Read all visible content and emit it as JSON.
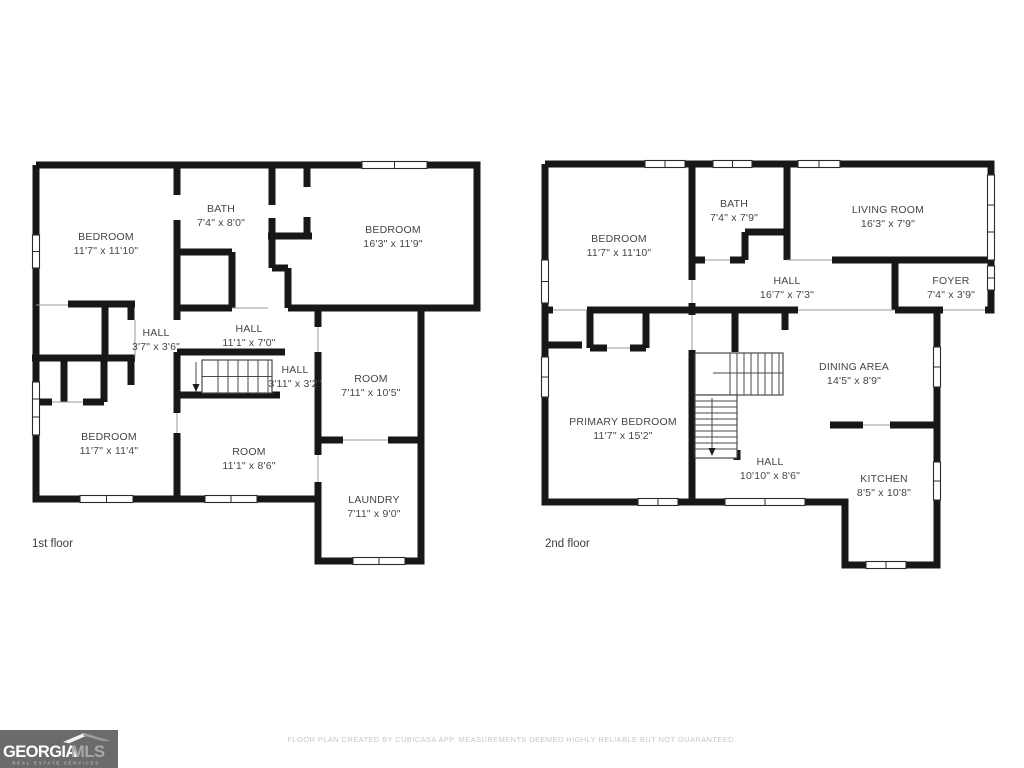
{
  "colors": {
    "wall": "#171717",
    "label_text": "#454545",
    "floor_label_text": "#3c3c3c",
    "disclaimer_text": "#c7c7c7",
    "logo_bg": "#6b6b6b",
    "logo_primary_text": "#ffffff",
    "logo_secondary_text": "#a9a9a9",
    "logo_tagline_text": "#b0b0b0"
  },
  "floors": [
    {
      "name": "1st floor",
      "rooms": [
        {
          "label": "BEDROOM",
          "dims": "11'7\" x 11'10\""
        },
        {
          "label": "BATH",
          "dims": "7'4\" x 8'0\""
        },
        {
          "label": "BEDROOM",
          "dims": "16'3\" x 11'9\""
        },
        {
          "label": "HALL",
          "dims": "3'7\" x 3'6\""
        },
        {
          "label": "HALL",
          "dims": "11'1\" x 7'0\""
        },
        {
          "label": "HALL",
          "dims": "3'11\" x 3'2\""
        },
        {
          "label": "ROOM",
          "dims": "7'11\" x 10'5\""
        },
        {
          "label": "BEDROOM",
          "dims": "11'7\" x 11'4\""
        },
        {
          "label": "ROOM",
          "dims": "11'1\" x 8'6\""
        },
        {
          "label": "LAUNDRY",
          "dims": "7'11\" x 9'0\""
        }
      ]
    },
    {
      "name": "2nd floor",
      "rooms": [
        {
          "label": "BEDROOM",
          "dims": "11'7\" x 11'10\""
        },
        {
          "label": "BATH",
          "dims": "7'4\" x 7'9\""
        },
        {
          "label": "LIVING ROOM",
          "dims": "16'3\" x 7'9\""
        },
        {
          "label": "HALL",
          "dims": "16'7\" x 7'3\""
        },
        {
          "label": "FOYER",
          "dims": "7'4\" x 3'9\""
        },
        {
          "label": "DINING AREA",
          "dims": "14'5\" x 8'9\""
        },
        {
          "label": "PRIMARY BEDROOM",
          "dims": "11'7\" x 15'2\""
        },
        {
          "label": "HALL",
          "dims": "10'10\" x 8'6\""
        },
        {
          "label": "KITCHEN",
          "dims": "8'5\" x 10'8\""
        }
      ]
    }
  ],
  "footer": {
    "disclaimer": "FLOOR PLAN CREATED BY CUBICASA APP. MEASUREMENTS DEEMED HIGHLY RELIABLE BUT NOT GUARANTEED."
  },
  "logo": {
    "brand_primary": "GEORGIA",
    "brand_secondary": "MLS",
    "tagline": "REAL ESTATE SERVICES"
  }
}
